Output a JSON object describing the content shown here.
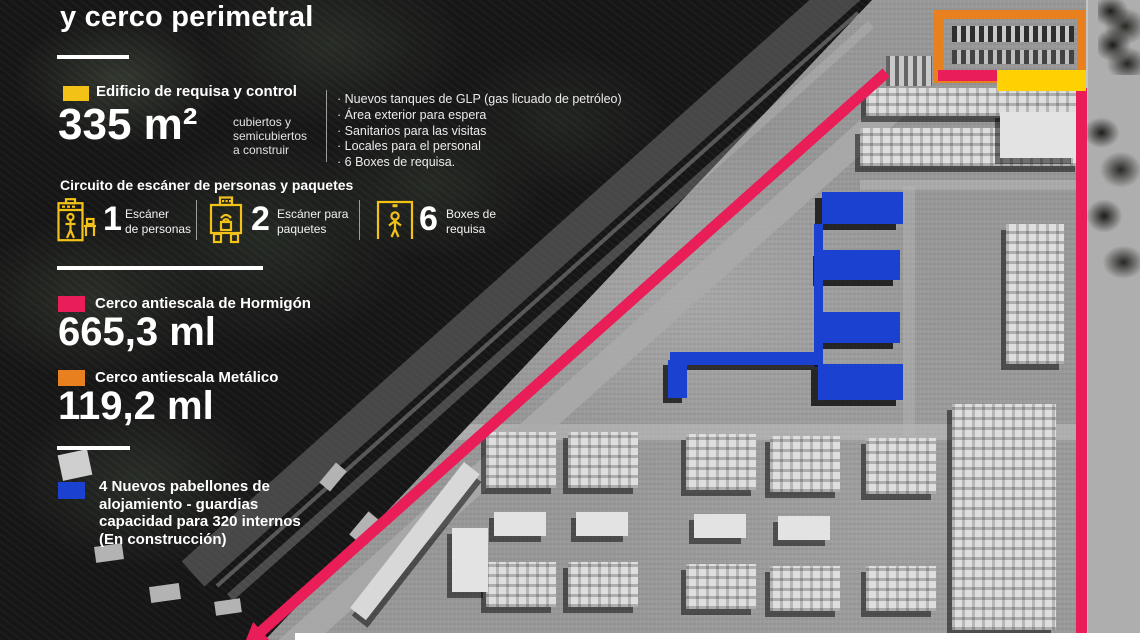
{
  "title": "y cerco perimetral",
  "colors": {
    "legend_yellow": "#F3C216",
    "map_yellow": "#FFD103",
    "pink": "#E91D58",
    "orange": "#E88020",
    "blue": "#1B41D1"
  },
  "requisa": {
    "label": "Edificio de requisa y control",
    "area_value": "335 m²",
    "area_note": "cubiertos y\nsemicubiertos\na construir",
    "features": [
      "Nuevos tanques de GLP (gas licuado de petróleo)",
      "Área exterior para espera",
      "Sanitarios para las visitas",
      "Locales para el personal",
      "6 Boxes de requisa."
    ]
  },
  "circuito": {
    "heading": "Circuito de escáner de personas y paquetes",
    "items": [
      {
        "icon": "person-scanner-icon",
        "count": "1",
        "label": "Escáner\nde personas"
      },
      {
        "icon": "package-scanner-icon",
        "count": "2",
        "label": "Escáner para\npaquetes"
      },
      {
        "icon": "requisa-box-icon",
        "count": "6",
        "label": "Boxes de\nrequisa"
      }
    ]
  },
  "fences": [
    {
      "label": "Cerco antiescala de Hormigón",
      "value": "665,3 ml",
      "color": "#E91D58"
    },
    {
      "label": "Cerco antiescala Metálico",
      "value": "119,2 ml",
      "color": "#E88020"
    }
  ],
  "pavilions": {
    "color": "#1B41D1",
    "text": "4 Nuevos pabellones de\nalojamiento -  guardias\ncapacidad para 320 internos\n(En construcción)"
  }
}
